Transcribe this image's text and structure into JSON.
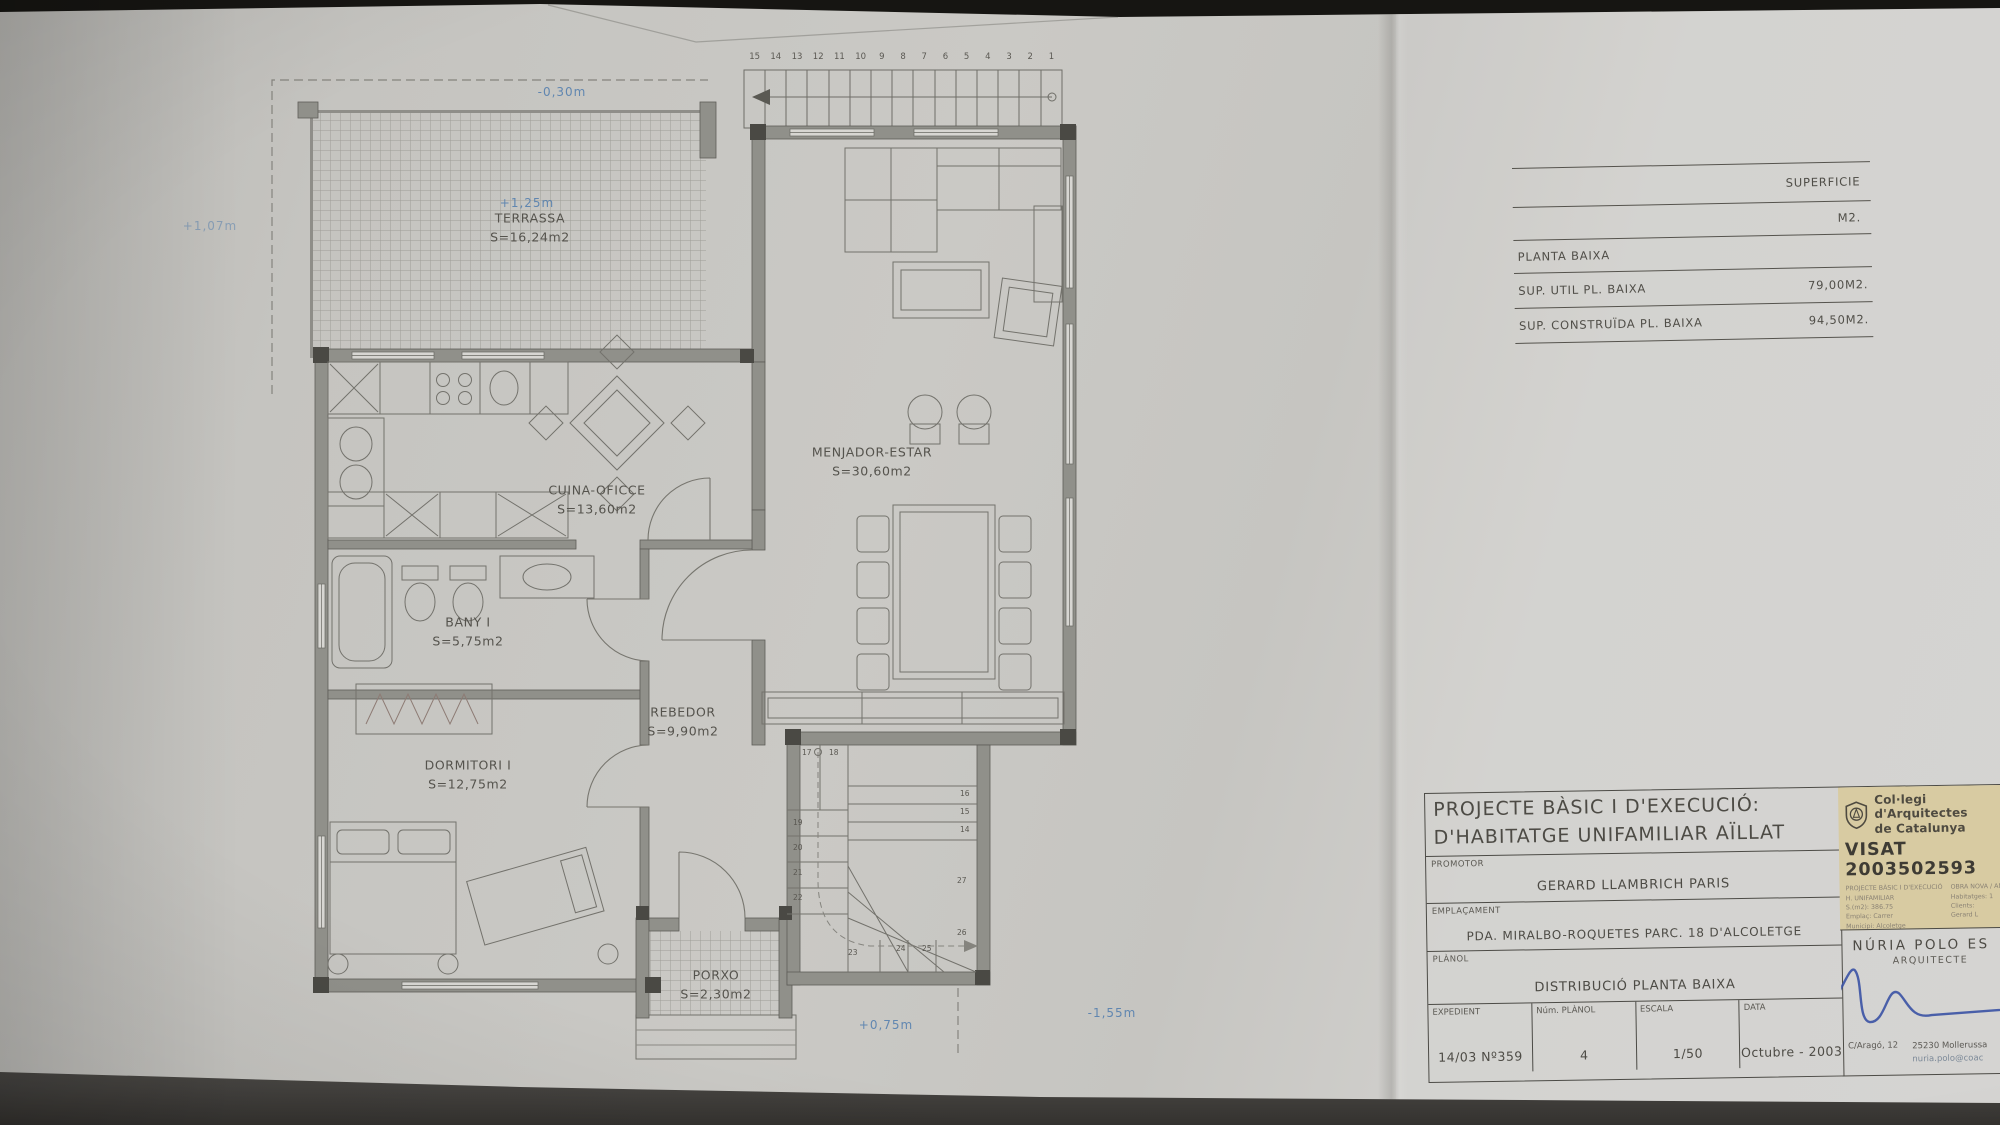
{
  "colors": {
    "accent_blue": "#4f7cae",
    "signature_blue": "#3a52a4",
    "paper": "#c8c7c3",
    "ink": "#514f4a",
    "wall_fill": "#90908a",
    "stamp_bg": "#d8cba2"
  },
  "plan": {
    "rooms": [
      {
        "name": "TERRASSA",
        "area": "S=16,24m2"
      },
      {
        "name": "CUINA-OFICCE",
        "area": "S=13,60m2"
      },
      {
        "name": "BANY I",
        "area": "S=5,75m2"
      },
      {
        "name": "DORMITORI I",
        "area": "S=12,75m2"
      },
      {
        "name": "REBEDOR",
        "area": "S=9,90m2"
      },
      {
        "name": "MENJADOR-ESTAR",
        "area": "S=30,60m2"
      },
      {
        "name": "PORXO",
        "area": "S=2,30m2"
      }
    ],
    "levels": {
      "terrace_top": "-0,30m",
      "terrace": "+1,25m",
      "outside_left": "+1,07m",
      "porch": "+0,75m",
      "garden": "-1,55m"
    },
    "stairs_top": [
      "15",
      "14",
      "13",
      "12",
      "11",
      "10",
      "9",
      "8",
      "7",
      "6",
      "5",
      "4",
      "3",
      "2",
      "1"
    ],
    "stairs_inner": [
      "17",
      "18",
      "16",
      "15",
      "14",
      "19",
      "20",
      "21",
      "22",
      "23",
      "24",
      "25",
      "26",
      "27"
    ]
  },
  "surface_table": {
    "col_header": "SUPERFICIE",
    "unit_header": "M2.",
    "section": "PLANTA BAIXA",
    "rows": [
      {
        "label": "SUP. UTIL PL. BAIXA",
        "value": "79,00M2."
      },
      {
        "label": "SUP. CONSTRUÏDA PL. BAIXA",
        "value": "94,50M2."
      }
    ]
  },
  "title_block": {
    "title_line1": "PROJECTE BÀSIC I D'EXECUCIÓ:",
    "title_line2": "D'HABITATGE UNIFAMILIAR AÏLLAT",
    "promotor_label": "PROMOTOR",
    "promotor": "GERARD LLAMBRICH PARIS",
    "emplacament_label": "EMPLAÇAMENT",
    "emplacament": "PDA. MIRALBO-ROQUETES PARC. 18 D'ALCOLETGE",
    "planol_label": "PLÀNOL",
    "planol": "DISTRIBUCIÓ PLANTA BAIXA",
    "expedient_label": "EXPEDIENT",
    "expedient": "14/03 Nº359",
    "num_planol_label": "Núm. PLÀNOL",
    "num_planol": "4",
    "escala_label": "ESCALA",
    "escala": "1/50",
    "data_label": "DATA",
    "data": "Octubre - 2003"
  },
  "stamp": {
    "org_line1": "Col·legi d'Arquitectes",
    "org_line2": "de Catalunya",
    "visat": "VISAT 2003502593",
    "small_left": [
      "PROJECTE BÀSIC I D'EXECUCIÓ",
      "H. UNIFAMILIAR",
      "S.(m2): 386.75",
      "Emplaç: Carrer",
      "Municipi: Alcoletge",
      "Arquitectes:",
      "Núria Polo i Escudé"
    ],
    "small_right": [
      "OBRA NOVA / AM",
      "Habitatges: 1",
      "Clients:",
      "Gerard L"
    ]
  },
  "architect": {
    "name": "NÚRIA POLO ES",
    "title": "ARQUITECTE",
    "address": "C/Aragó, 12",
    "city": "25230 Mollerussa",
    "email": "nuria.polo@coac"
  }
}
